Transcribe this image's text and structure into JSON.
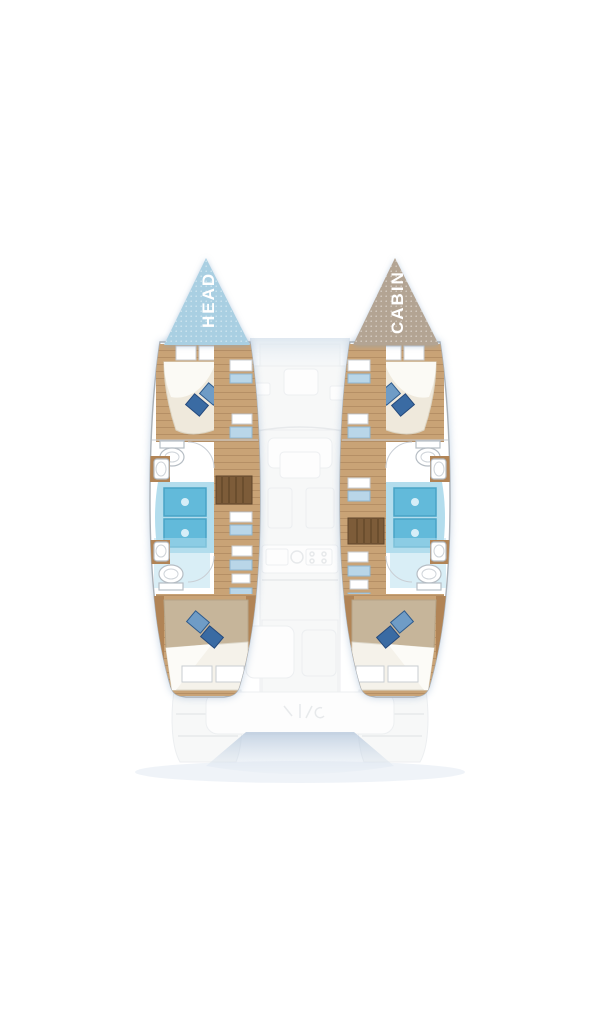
{
  "bow_labels": {
    "left": "HEAD",
    "right": "CABIN"
  },
  "rooms": {
    "left_bow": "HEAD",
    "right_bow": "CABIN"
  },
  "colors": {
    "bow_head": "#a9cfe2",
    "bow_cabin": "#b3a493",
    "label_text": "#ffffff",
    "hull_fill": "#ffffff",
    "hull_outline": "#a9b0b7",
    "wood": "#c9a376",
    "wood_mid": "#b18456",
    "wood_dark": "#7d5c39",
    "mattress": "#efe9dc",
    "sheet": "#fbfaf5",
    "blanket": "#c6b59a",
    "pillow_light": "#6f9cc6",
    "pillow_dark": "#3a6ba3",
    "shower_floor": "#b3dded",
    "shower_tray": "#62bada",
    "shower_tray_edge": "#47a3c6",
    "fixture_outline": "#b6bdc4",
    "ghost_fill": "#f2f4f5",
    "ghost_stroke": "#e0e4e7",
    "ghost_white": "#fcfdfd",
    "bow_wash": "#c4d4e3",
    "stern_shadow": "#b7c8dc"
  }
}
